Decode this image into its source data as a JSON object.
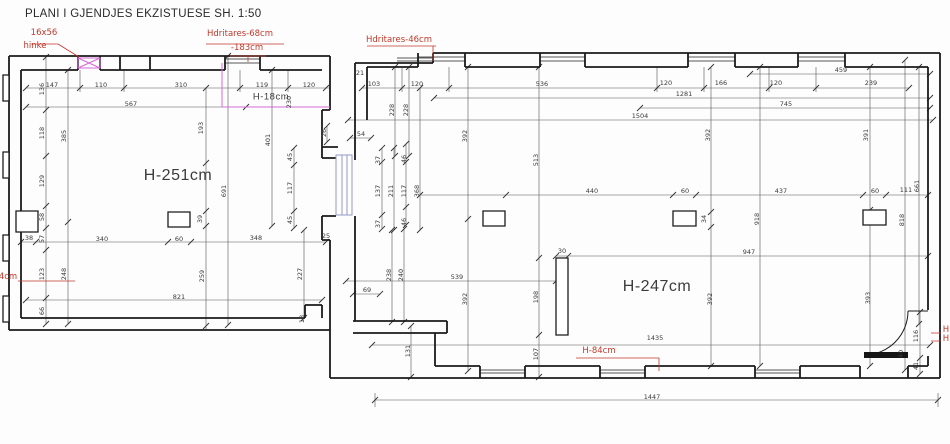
{
  "title": "PLANI I GJENDJES EKZISTUESE SH. 1:50",
  "scale": "1:50",
  "colors": {
    "wall": "#1b1b1b",
    "dim": "#4a4a4a",
    "red": "#c0392b",
    "magenta": "#d56ad5",
    "blue": "#9299c7"
  },
  "room_labels": [
    {
      "t": "H-251cm",
      "x": 178,
      "y": 176,
      "s": 16
    },
    {
      "t": "H-247cm",
      "x": 657,
      "y": 287,
      "s": 16
    },
    {
      "t": "H-18cm",
      "x": 271,
      "y": 97,
      "s": 9.5
    }
  ],
  "red_labels": [
    {
      "t": "16x56",
      "x": 44,
      "y": 33
    },
    {
      "t": "hinke",
      "x": 35,
      "y": 46
    },
    {
      "t": "Hdritares-68cm",
      "x": 240,
      "y": 34
    },
    {
      "t": "-183cm",
      "x": 247,
      "y": 48
    },
    {
      "t": "Hdritares-46cm",
      "x": 399,
      "y": 40
    },
    {
      "t": "H-84cm",
      "x": 599,
      "y": 351
    },
    {
      "t": "4cm",
      "x": 8,
      "y": 277
    },
    {
      "t": "H",
      "x": 946,
      "y": 330
    },
    {
      "t": "H",
      "x": 946,
      "y": 339
    }
  ],
  "dim_labels": [
    {
      "t": "147",
      "x": 52,
      "y": 85
    },
    {
      "t": "136",
      "x": 42,
      "y": 89,
      "r": 1
    },
    {
      "t": "110",
      "x": 101,
      "y": 85
    },
    {
      "t": "310",
      "x": 181,
      "y": 85
    },
    {
      "t": "119",
      "x": 262,
      "y": 85
    },
    {
      "t": "120",
      "x": 309,
      "y": 85
    },
    {
      "t": "567",
      "x": 131,
      "y": 104
    },
    {
      "t": "118",
      "x": 42,
      "y": 133,
      "r": 1
    },
    {
      "t": "385",
      "x": 64,
      "y": 136,
      "r": 1
    },
    {
      "t": "129",
      "x": 42,
      "y": 181,
      "r": 1
    },
    {
      "t": "58",
      "x": 42,
      "y": 217,
      "r": 1
    },
    {
      "t": "38",
      "x": 29,
      "y": 238
    },
    {
      "t": "57",
      "x": 42,
      "y": 239,
      "r": 1
    },
    {
      "t": "123",
      "x": 42,
      "y": 274,
      "r": 1
    },
    {
      "t": "66",
      "x": 42,
      "y": 311,
      "r": 1
    },
    {
      "t": "248",
      "x": 64,
      "y": 274,
      "r": 1
    },
    {
      "t": "193",
      "x": 201,
      "y": 128,
      "r": 1
    },
    {
      "t": "691",
      "x": 224,
      "y": 191,
      "r": 1
    },
    {
      "t": "401",
      "x": 268,
      "y": 140,
      "r": 1
    },
    {
      "t": "230",
      "x": 289,
      "y": 102,
      "r": 1
    },
    {
      "t": "45",
      "x": 290,
      "y": 157,
      "r": 1
    },
    {
      "t": "117",
      "x": 290,
      "y": 188,
      "r": 1
    },
    {
      "t": "45",
      "x": 290,
      "y": 220,
      "r": 1
    },
    {
      "t": "39",
      "x": 200,
      "y": 219,
      "r": 1
    },
    {
      "t": "340",
      "x": 102,
      "y": 239
    },
    {
      "t": "60",
      "x": 179,
      "y": 239
    },
    {
      "t": "348",
      "x": 256,
      "y": 238
    },
    {
      "t": "25",
      "x": 326,
      "y": 236
    },
    {
      "t": "259",
      "x": 202,
      "y": 276,
      "r": 1
    },
    {
      "t": "227",
      "x": 300,
      "y": 274,
      "r": 1
    },
    {
      "t": "821",
      "x": 179,
      "y": 297
    },
    {
      "t": "18",
      "x": 302,
      "y": 319,
      "r": 1
    },
    {
      "t": "26",
      "x": 324,
      "y": 133,
      "r": 1
    },
    {
      "t": "54",
      "x": 361,
      "y": 134
    },
    {
      "t": "37",
      "x": 378,
      "y": 160,
      "r": 1
    },
    {
      "t": "46",
      "x": 404,
      "y": 159,
      "r": 1
    },
    {
      "t": "137",
      "x": 378,
      "y": 191,
      "r": 1
    },
    {
      "t": "211",
      "x": 391,
      "y": 191,
      "r": 1
    },
    {
      "t": "117",
      "x": 404,
      "y": 191,
      "r": 1
    },
    {
      "t": "368",
      "x": 417,
      "y": 191,
      "r": 1
    },
    {
      "t": "37",
      "x": 378,
      "y": 224,
      "r": 1
    },
    {
      "t": "46",
      "x": 404,
      "y": 222,
      "r": 1
    },
    {
      "t": "238",
      "x": 389,
      "y": 275,
      "r": 1
    },
    {
      "t": "240",
      "x": 401,
      "y": 275,
      "r": 1
    },
    {
      "t": "69",
      "x": 367,
      "y": 290
    },
    {
      "t": "131",
      "x": 408,
      "y": 351,
      "r": 1
    },
    {
      "t": "21",
      "x": 360,
      "y": 73
    },
    {
      "t": "103",
      "x": 374,
      "y": 84
    },
    {
      "t": "120",
      "x": 417,
      "y": 84
    },
    {
      "t": "536",
      "x": 542,
      "y": 84
    },
    {
      "t": "228",
      "x": 392,
      "y": 110,
      "r": 1
    },
    {
      "t": "228",
      "x": 406,
      "y": 110,
      "r": 1
    },
    {
      "t": "120",
      "x": 666,
      "y": 83
    },
    {
      "t": "166",
      "x": 721,
      "y": 83
    },
    {
      "t": "120",
      "x": 776,
      "y": 83
    },
    {
      "t": "239",
      "x": 871,
      "y": 83
    },
    {
      "t": "459",
      "x": 841,
      "y": 70
    },
    {
      "t": "1281",
      "x": 684,
      "y": 94
    },
    {
      "t": "745",
      "x": 786,
      "y": 104
    },
    {
      "t": "1504",
      "x": 640,
      "y": 116
    },
    {
      "t": "392",
      "x": 465,
      "y": 136,
      "r": 1
    },
    {
      "t": "513",
      "x": 536,
      "y": 160,
      "r": 1
    },
    {
      "t": "392",
      "x": 708,
      "y": 135,
      "r": 1
    },
    {
      "t": "391",
      "x": 866,
      "y": 135,
      "r": 1
    },
    {
      "t": "440",
      "x": 592,
      "y": 191
    },
    {
      "t": "60",
      "x": 685,
      "y": 191
    },
    {
      "t": "437",
      "x": 781,
      "y": 191
    },
    {
      "t": "60",
      "x": 875,
      "y": 191
    },
    {
      "t": "111",
      "x": 906,
      "y": 190
    },
    {
      "t": "661",
      "x": 917,
      "y": 186,
      "r": 1
    },
    {
      "t": "34",
      "x": 704,
      "y": 219,
      "r": 1
    },
    {
      "t": "918",
      "x": 757,
      "y": 219,
      "r": 1
    },
    {
      "t": "818",
      "x": 902,
      "y": 220,
      "r": 1
    },
    {
      "t": "947",
      "x": 749,
      "y": 252
    },
    {
      "t": "539",
      "x": 457,
      "y": 277
    },
    {
      "t": "30",
      "x": 562,
      "y": 251
    },
    {
      "t": "392",
      "x": 465,
      "y": 299,
      "r": 1
    },
    {
      "t": "198",
      "x": 536,
      "y": 297,
      "r": 1
    },
    {
      "t": "107",
      "x": 536,
      "y": 354,
      "r": 1
    },
    {
      "t": "392",
      "x": 710,
      "y": 299,
      "r": 1
    },
    {
      "t": "393",
      "x": 868,
      "y": 298,
      "r": 1
    },
    {
      "t": "1435",
      "x": 655,
      "y": 338
    },
    {
      "t": "1447",
      "x": 652,
      "y": 397
    },
    {
      "t": "116",
      "x": 916,
      "y": 336,
      "r": 1
    },
    {
      "t": "41",
      "x": 916,
      "y": 366,
      "r": 1
    },
    {
      "t": "40",
      "x": 901,
      "y": 354,
      "r": 1
    }
  ]
}
